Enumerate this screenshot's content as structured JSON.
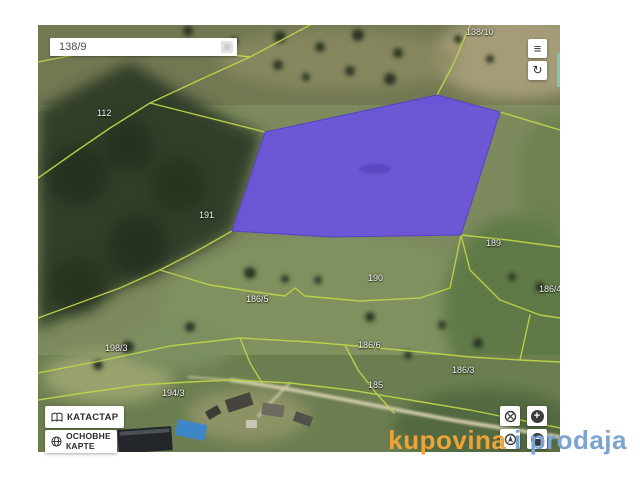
{
  "search": {
    "value": "138/9"
  },
  "topbar_buttons": {
    "menu": "≡",
    "refresh": "↻"
  },
  "layer_buttons": {
    "katastar": "КАТАСТАР",
    "osnovne1": "ОСНОВНЕ",
    "osnovne2": "КАРТЕ"
  },
  "zoom_buttons": {
    "zoom_in": "+",
    "zoom_out": "−"
  },
  "watermark": {
    "kupovina": "kupovina",
    "i": " i ",
    "prodaja": "prodaja",
    "orange_color": "#eca438",
    "blue_color": "#7ba4d0"
  },
  "map": {
    "highlight_color": "#6b53de",
    "boundary_color": "#bdd349",
    "parcel_labels": [
      {
        "text": "138/10",
        "x": 428,
        "y": 2
      },
      {
        "text": "112",
        "x": 59,
        "y": 83
      },
      {
        "text": "191",
        "x": 161,
        "y": 185
      },
      {
        "text": "189",
        "x": 448,
        "y": 213
      },
      {
        "text": "190",
        "x": 330,
        "y": 248
      },
      {
        "text": "186/5",
        "x": 208,
        "y": 269
      },
      {
        "text": "186/4",
        "x": 501,
        "y": 259
      },
      {
        "text": "198/3",
        "x": 67,
        "y": 318
      },
      {
        "text": "186/6",
        "x": 320,
        "y": 315
      },
      {
        "text": "194/3",
        "x": 124,
        "y": 363
      },
      {
        "text": "185",
        "x": 330,
        "y": 355
      },
      {
        "text": "186/3",
        "x": 414,
        "y": 340
      }
    ]
  }
}
